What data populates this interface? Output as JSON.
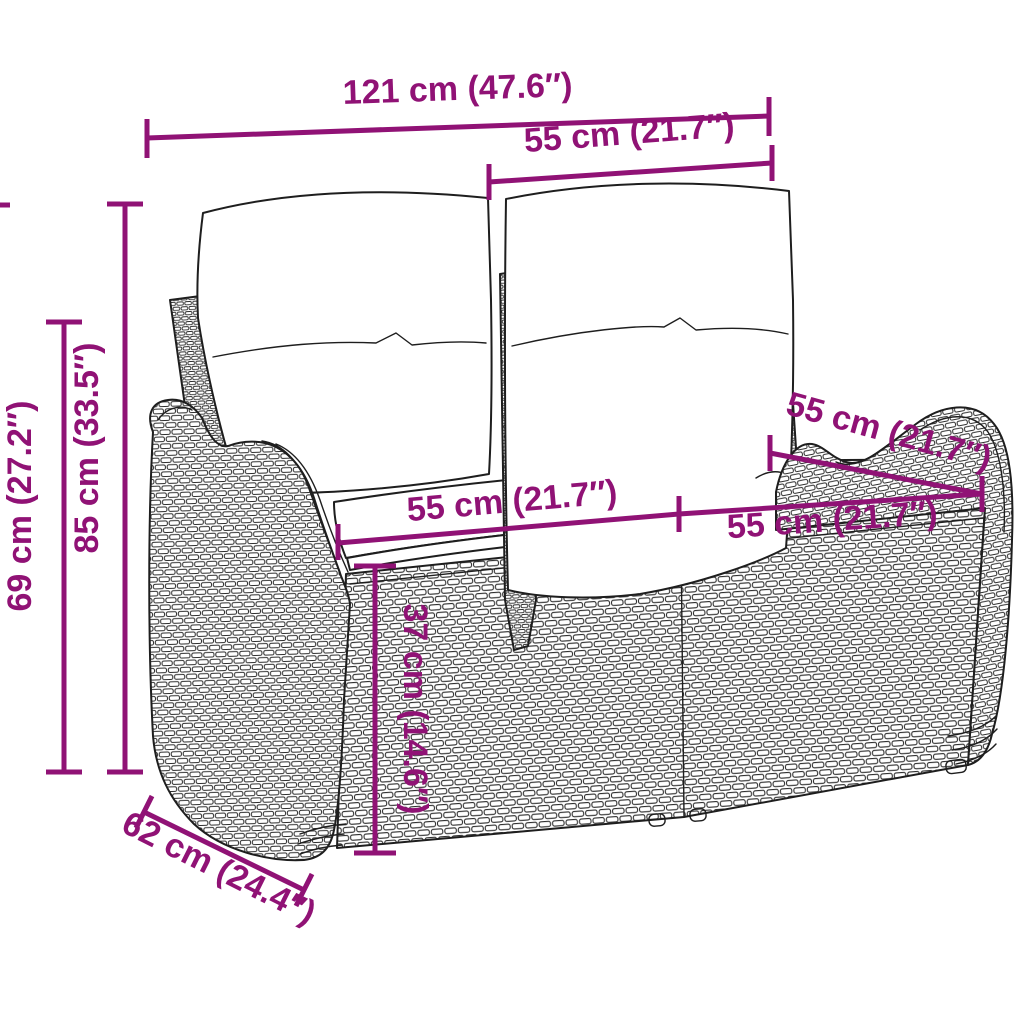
{
  "diagram": {
    "subject": "Poly rattan two-seater garden bench with back and seat cushions — dimension drawing",
    "style": {
      "annotation_color": "#901275",
      "art_line_color": "#1e1e1e",
      "background": "#ffffff",
      "cushion_fill": "#ffffff"
    },
    "dimensions": [
      {
        "id": "overall-width",
        "label": "121 cm (47.6″)"
      },
      {
        "id": "backrest-width",
        "label": "55 cm (21.7″)"
      },
      {
        "id": "overall-height",
        "label": "85 cm (33.5″)"
      },
      {
        "id": "armrest-height",
        "label": "69 cm (27.2″)"
      },
      {
        "id": "seat-depth-top",
        "label": "55 cm (21.7″)"
      },
      {
        "id": "seat-width-left",
        "label": "55 cm (21.7″)"
      },
      {
        "id": "seat-width-right",
        "label": "55 cm (21.7″)"
      },
      {
        "id": "seat-height",
        "label": "37 cm (14.6″)"
      },
      {
        "id": "overall-depth",
        "label": "62 cm (24.4″)"
      }
    ]
  }
}
